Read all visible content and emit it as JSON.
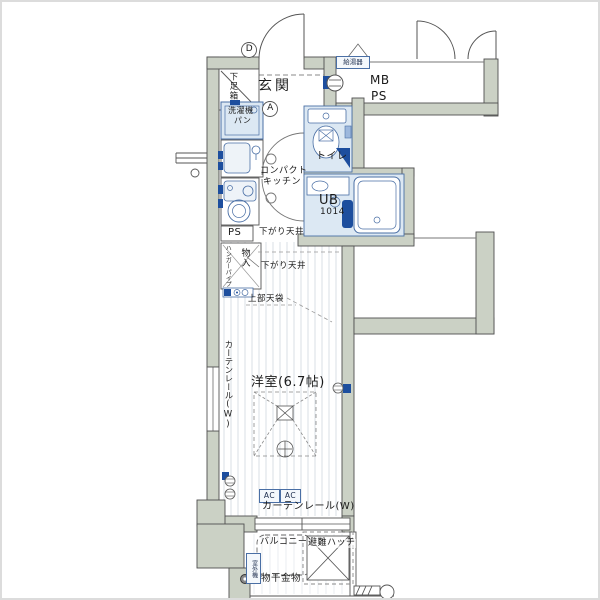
{
  "floor_plan": {
    "rooms": {
      "genkan": "玄関",
      "western_room": "洋室(6.7帖)",
      "toilet": "トイレ",
      "unit_bath": "UB",
      "unit_bath_size": "1014",
      "balcony": "バルコニー",
      "compact_kitchen_l1": "コンパクト",
      "compact_kitchen_l2": "キッチン"
    },
    "fixtures": {
      "shoe_box": "下足箱",
      "washer_pan_l1": "洗濯機",
      "washer_pan_l2": "パン",
      "water_heater": "給湯器",
      "meter_box": "MB",
      "pipe_space_top": "PS",
      "pipe_space_mid": "PS",
      "storage": "物入",
      "hanger_pipe": "ハンガーパイプ",
      "upper_cabinet": "上部天袋",
      "outdoor_unit": "室外機"
    },
    "notes": {
      "lowered_ceiling_1": "下がり天井",
      "lowered_ceiling_2": "下がり天井",
      "curtain_rail_left": "カーテンレール(W)",
      "curtain_rail_bottom": "カーテンレール(W)",
      "ac_left": "AC",
      "ac_right": "AC",
      "evacuation_hatch": "避難ハッチ",
      "laundry_hardware": "物干金物"
    },
    "markers": {
      "door_d": "D",
      "door_a": "A"
    },
    "colors": {
      "wall_fill": "#cbd1c5",
      "wall_line": "#4f4f4f",
      "fixture_fill": "#dce8f3",
      "fixture_line": "#4a6fa5",
      "accent_blue": "#1d4e9e",
      "floor_stripe": "#c9d2da"
    }
  }
}
